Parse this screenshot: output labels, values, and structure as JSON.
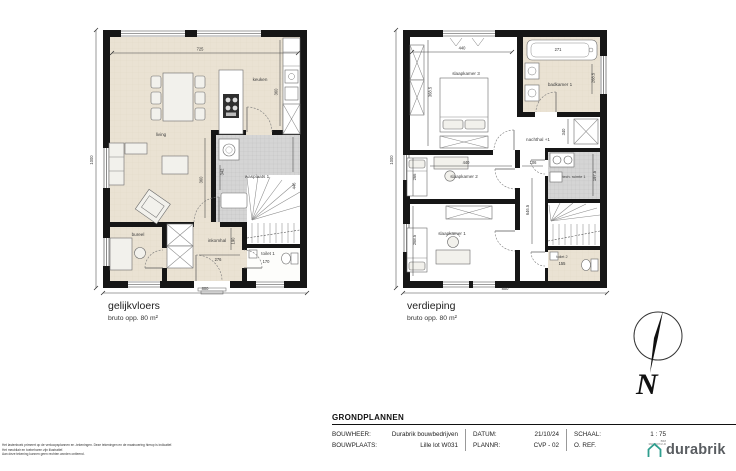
{
  "plans": {
    "ground": {
      "title": "gelijkvloers",
      "subtitle": "bruto opp. 80 m²",
      "rooms": {
        "living": "living",
        "keuken": "keuken",
        "wasplaats": "wasplaats 1",
        "bureel": "bureel",
        "inkomhal": "inkomhal",
        "toilet": "toilet 1"
      },
      "dims": {
        "top": "725",
        "keuken_depth": "360",
        "living_side": "360",
        "wasplaats_left": "342",
        "wasplaats_right": "446",
        "inkomhal_width": "276",
        "inkomhal_height": "190",
        "toilet_width": "170",
        "bottom": "800",
        "side": "1000"
      }
    },
    "upper": {
      "title": "verdieping",
      "subtitle": "bruto opp. 80 m²",
      "rooms": {
        "sk3": "slaapkamer 3",
        "badkamer": "badkamer 1",
        "nachthal": "nachthal +1",
        "sk2": "slaapkamer 2",
        "tech": "tech. ruimte 1",
        "sk1": "slaapkamer 1",
        "toilet": "toilet 2"
      },
      "dims": {
        "sk3_width": "440",
        "sk3_side": "368.5",
        "bath": "271",
        "badkamer_side": "268.5",
        "closet": "340",
        "sk2_side": "266",
        "sk2_width": "440",
        "hall_width": "106",
        "hall_length": "646.5",
        "tech_side": "197.5",
        "sk1_side": "268.5",
        "toilet_width": "155",
        "bottom": "800",
        "side": "1000"
      }
    }
  },
  "north_label": "N",
  "titleblock": {
    "heading": "GRONDPLANNEN",
    "bouwheer_label": "BOUWHEER:",
    "bouwheer_value": "Durabrik bouwbedrijven",
    "bouwplaats_label": "BOUWPLAATS:",
    "bouwplaats_value": "Lille lot W031",
    "datum_label": "DATUM:",
    "datum_value": "21/10/24",
    "plannr_label": "PLANNR:",
    "plannr_value": "CVP - 02",
    "schaal_label": "SCHAAL:",
    "schaal_value": "1 : 75",
    "oref_label": "O. REF.",
    "fine_print": [
      "BIM",
      "360/W07/2-D"
    ],
    "logo_text": "durabrik"
  },
  "disclaimer": [
    "Het lastenboek primeert op de verkoopsplannen en -tekeningen. Deze tekeningen en de maatvoering hierop is indicatief.",
    "Het meubilair en toebehoren zijn illustratief.",
    "Aan deze tekening kunnen geen rechten worden ontleend."
  ],
  "colors": {
    "accent": "#2F9E8E",
    "floor_beige": "#EAE2D3",
    "hatch_gray": "#D5D5D5",
    "logo_gray": "#595D61"
  }
}
